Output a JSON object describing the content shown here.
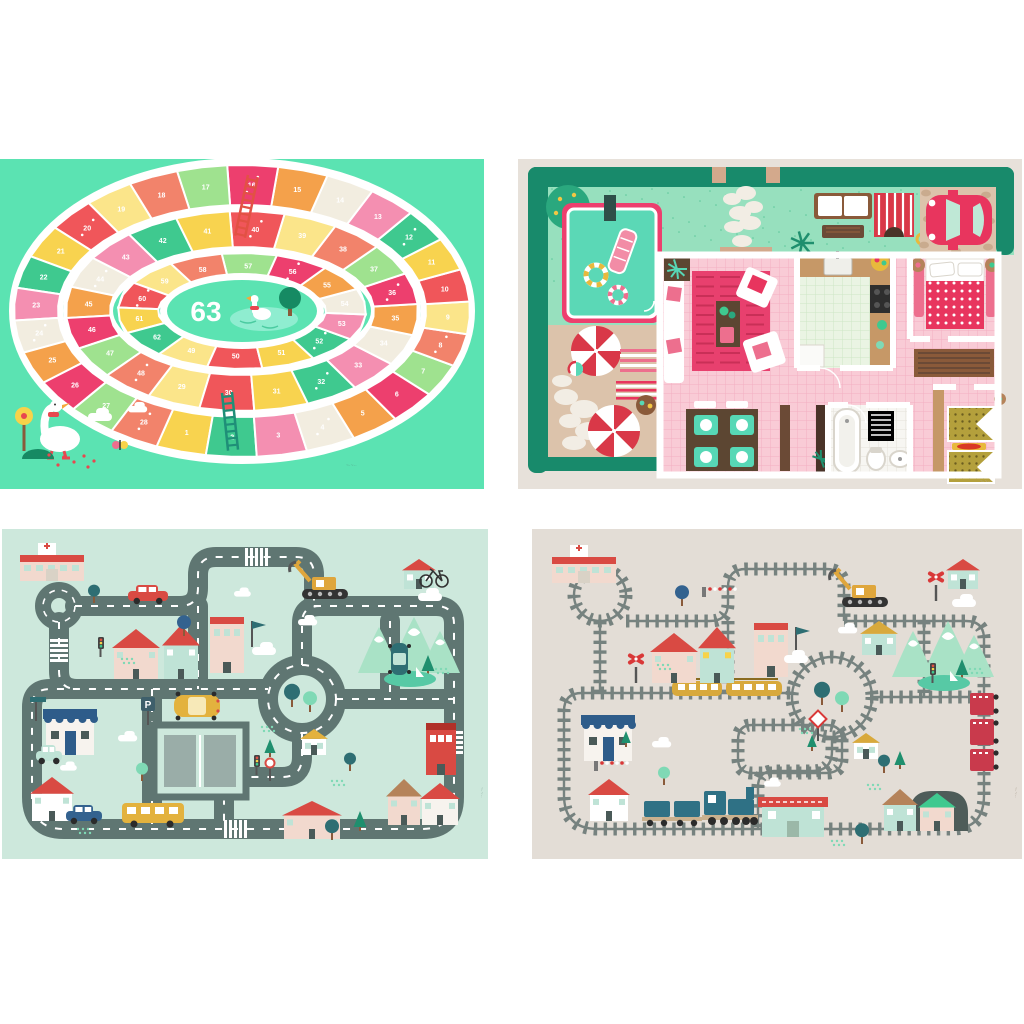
{
  "goose_game_mat": {
    "center_label": "63",
    "cell_count": 63,
    "signature": "~·~··",
    "colors": {
      "bg": "#5BE3B2",
      "track": "#FFFFFF",
      "pond": "#8FEDD0",
      "pond_line": "#4ACBA0",
      "tree": "#168A63",
      "beak": "#F4A83C",
      "accent_red": "#E8474F",
      "ladder_red": "#E25144",
      "ladder_teal": "#1F8F78",
      "sign_yellow": "#F7D34A",
      "bush": "#168A63",
      "signature": "#57B193",
      "palette": [
        "#F0565A",
        "#F8D34F",
        "#3FC98F",
        "#F48FB1",
        "#F2EDE0",
        "#F4A14B",
        "#ED3F6E",
        "#9FE28F",
        "#F2836B",
        "#FBE58A"
      ]
    }
  },
  "dollhouse_mat": {
    "signature": "~·~··",
    "colors": {
      "bg": "#E7E1DA",
      "hedge": "#188A6B",
      "grass": "#97E0BE",
      "grass_dot": "#5FC79C",
      "pool_water": "#5BD8B6",
      "pool_border": "#ED3F6E",
      "board": "#2E4F48",
      "patio": "#DCC3AB",
      "stone": "#F2EDE4",
      "umbrella_red": "#D93848",
      "towel_pink": "#ED6F8E",
      "towel_red": "#E8355E",
      "wall": "#FFFFFF",
      "floor_pink": "#F9CBD6",
      "grid_pink": "#F2AFC2",
      "rug": "#E8406E",
      "rug_line": "#C92F57",
      "kitchen_floor": "#EAF4E3",
      "grid_green": "#CDE6C6",
      "bath_floor": "#F7F6F2",
      "grid_bath": "#E4E2DB",
      "counter": "#C69867",
      "wood_dark": "#5C4632",
      "stove": "#2E2E2E",
      "blanket": "#E8355E",
      "bunk_blanket": "#B4A03C",
      "rug_red": "#D93826",
      "mint": "#57D8B6",
      "car": "#E8355E",
      "glass": "#BFE8D6",
      "signature": "#B3A99C"
    }
  },
  "road_mat": {
    "parking_label": "P",
    "signature": "~·~··",
    "colors": {
      "bg": "#CDE8DC",
      "road": "#5F7672",
      "dash": "#FFFFFF",
      "stall": "#9AADA8",
      "sign_blue": "#3E5F6B",
      "red": "#D94A43",
      "cream": "#F2D9CE",
      "white": "#F7F3EE",
      "mintb": "#BFE3D6",
      "awning": "#2E5C8A",
      "bus": "#E3B23E",
      "blue_car": "#33628F",
      "digger": "#DFA63C",
      "mountain": "#A9E2C6",
      "pine": "#1F8F6E",
      "tree_teal": "#2E6E73",
      "tree_mint": "#7FD9B5",
      "lake": "#57C9A5",
      "signature": "#9DBBAE"
    }
  },
  "railway_mat": {
    "signature": "~·~··",
    "colors": {
      "bg": "#E3DDD6",
      "rail": "#76827F",
      "tunnel": "#4E5C59",
      "tunnel_hole": "#333D3B",
      "train": "#2F7185",
      "train_base": "#C9B18F",
      "wheel": "#2B2B2B",
      "tram": "#D8A93C",
      "caboose": "#C93A4C",
      "crossing": "#D93838",
      "red": "#D94A43",
      "cream": "#F2D9CE",
      "white": "#F7F3EE",
      "mintb": "#BFE3D6",
      "awning": "#2E5C8A",
      "digger": "#DFA63C",
      "mountain": "#A9E2C6",
      "pine": "#1F8F6E",
      "tree_teal": "#2E6E73",
      "tree_mint": "#7FD9B5",
      "lake": "#57C9A5",
      "signature": "#B3A99C"
    }
  }
}
